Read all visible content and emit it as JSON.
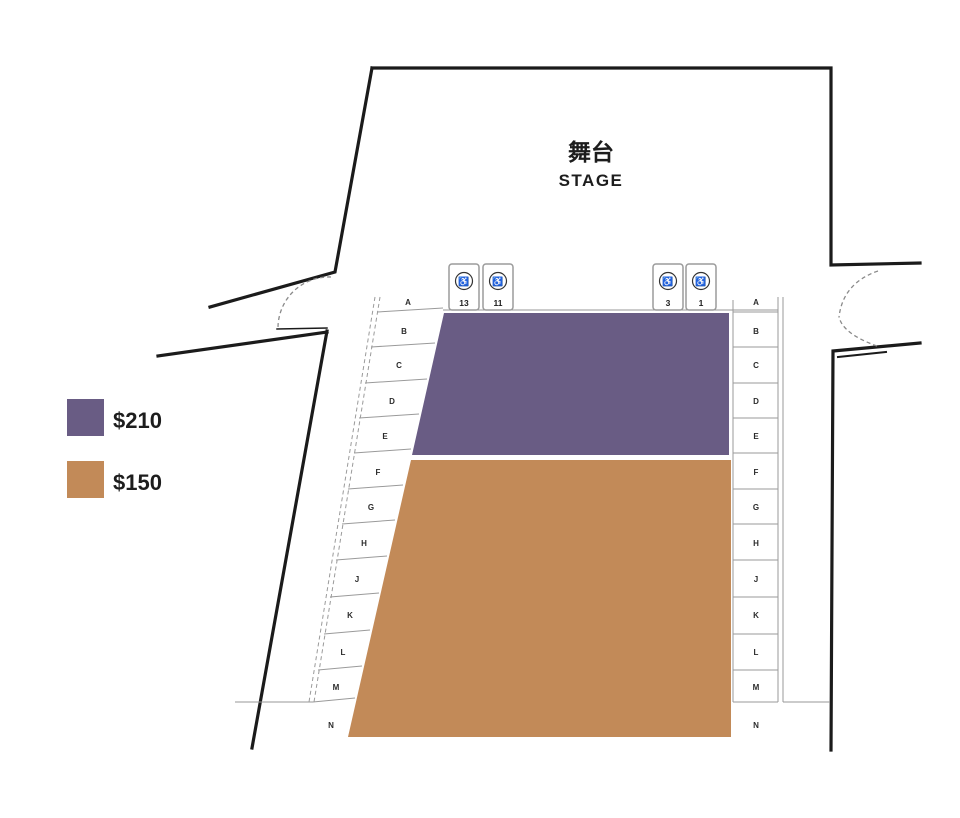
{
  "stage": {
    "title_zh": "舞台",
    "title_en": "STAGE"
  },
  "legend": {
    "items": [
      {
        "price": "$210",
        "color": "#695C84"
      },
      {
        "price": "$150",
        "color": "#C28A58"
      }
    ]
  },
  "sections": {
    "front": {
      "price": "$210",
      "color": "#695C84"
    },
    "rear": {
      "price": "$150",
      "color": "#C28A58"
    }
  },
  "rows": [
    "A",
    "B",
    "C",
    "D",
    "E",
    "F",
    "G",
    "H",
    "J",
    "K",
    "L",
    "M",
    "N"
  ],
  "accessible_seats": {
    "left": [
      {
        "number": "13"
      },
      {
        "number": "11"
      }
    ],
    "right": [
      {
        "number": "3"
      },
      {
        "number": "1"
      }
    ]
  },
  "icons": {
    "wheelchair": "♿"
  }
}
